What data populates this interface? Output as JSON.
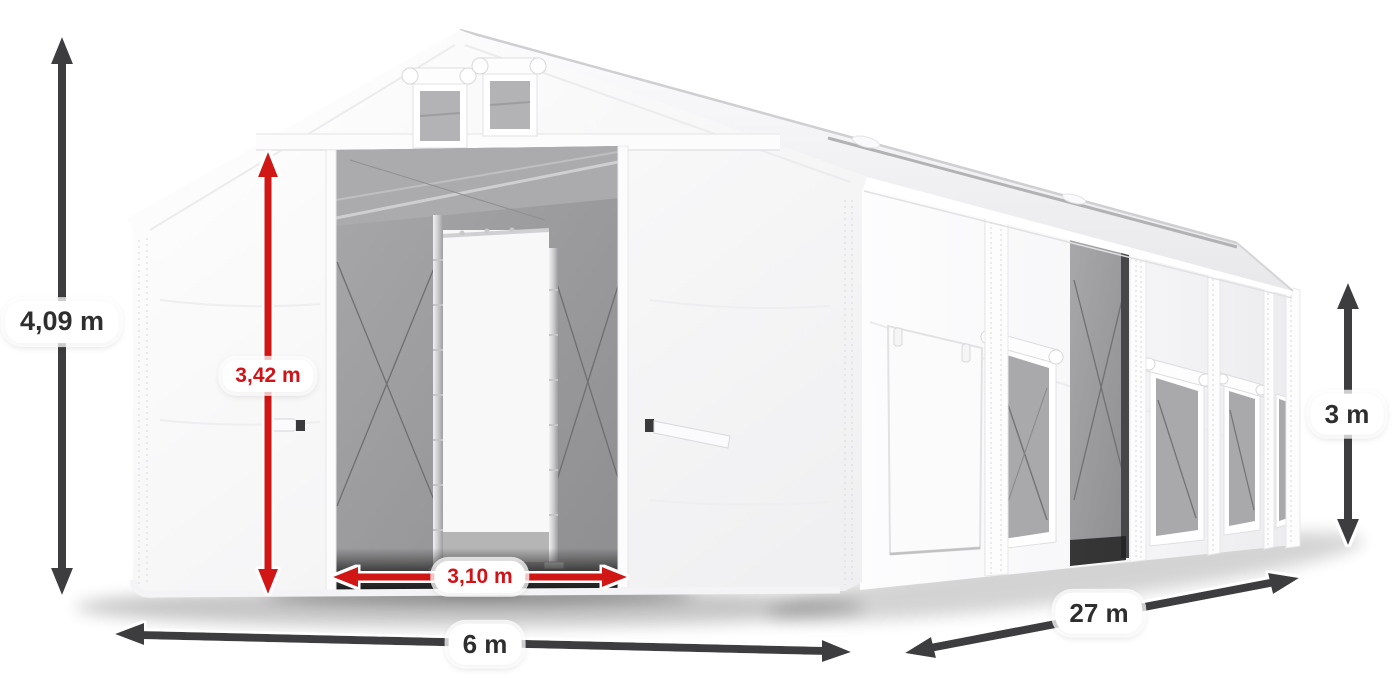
{
  "scene": {
    "description": "White warehouse storage tent 6 m x 27 m shown in perspective with open front gates, mesh side windows, one open side entrance and six dimension arrows",
    "background_color": "#ffffff"
  },
  "colors": {
    "dimension_arrow_dark": "#3d3d3f",
    "dimension_arrow_red": "#d11217",
    "label_pill_background": "#ffffff",
    "label_text_dark": "#2e2e2e",
    "label_text_red": "#d11217",
    "tent_fabric_white": "#f9f9fb",
    "tent_interior_gray": "#9b9b9d",
    "aluminium_frame": "#c9c9cb",
    "ground_shadow": "#000000"
  },
  "dimensions": {
    "total_height": {
      "label": "4,09 m",
      "style": "dark",
      "axis": "vertical",
      "location": "left-of-tent"
    },
    "clear_height": {
      "label": "3,42 m",
      "style": "red",
      "axis": "vertical",
      "location": "front-left-panel"
    },
    "entrance_width": {
      "label": "3,10 m",
      "style": "red",
      "axis": "horizontal",
      "location": "front-entrance-base"
    },
    "width": {
      "label": "6 m",
      "style": "dark",
      "axis": "horizontal",
      "location": "below-front-gable"
    },
    "length": {
      "label": "27 m",
      "style": "dark",
      "axis": "diagonal",
      "location": "along-right-side"
    },
    "side_height": {
      "label": "3 m",
      "style": "dark",
      "axis": "vertical",
      "location": "right-of-tent"
    }
  }
}
